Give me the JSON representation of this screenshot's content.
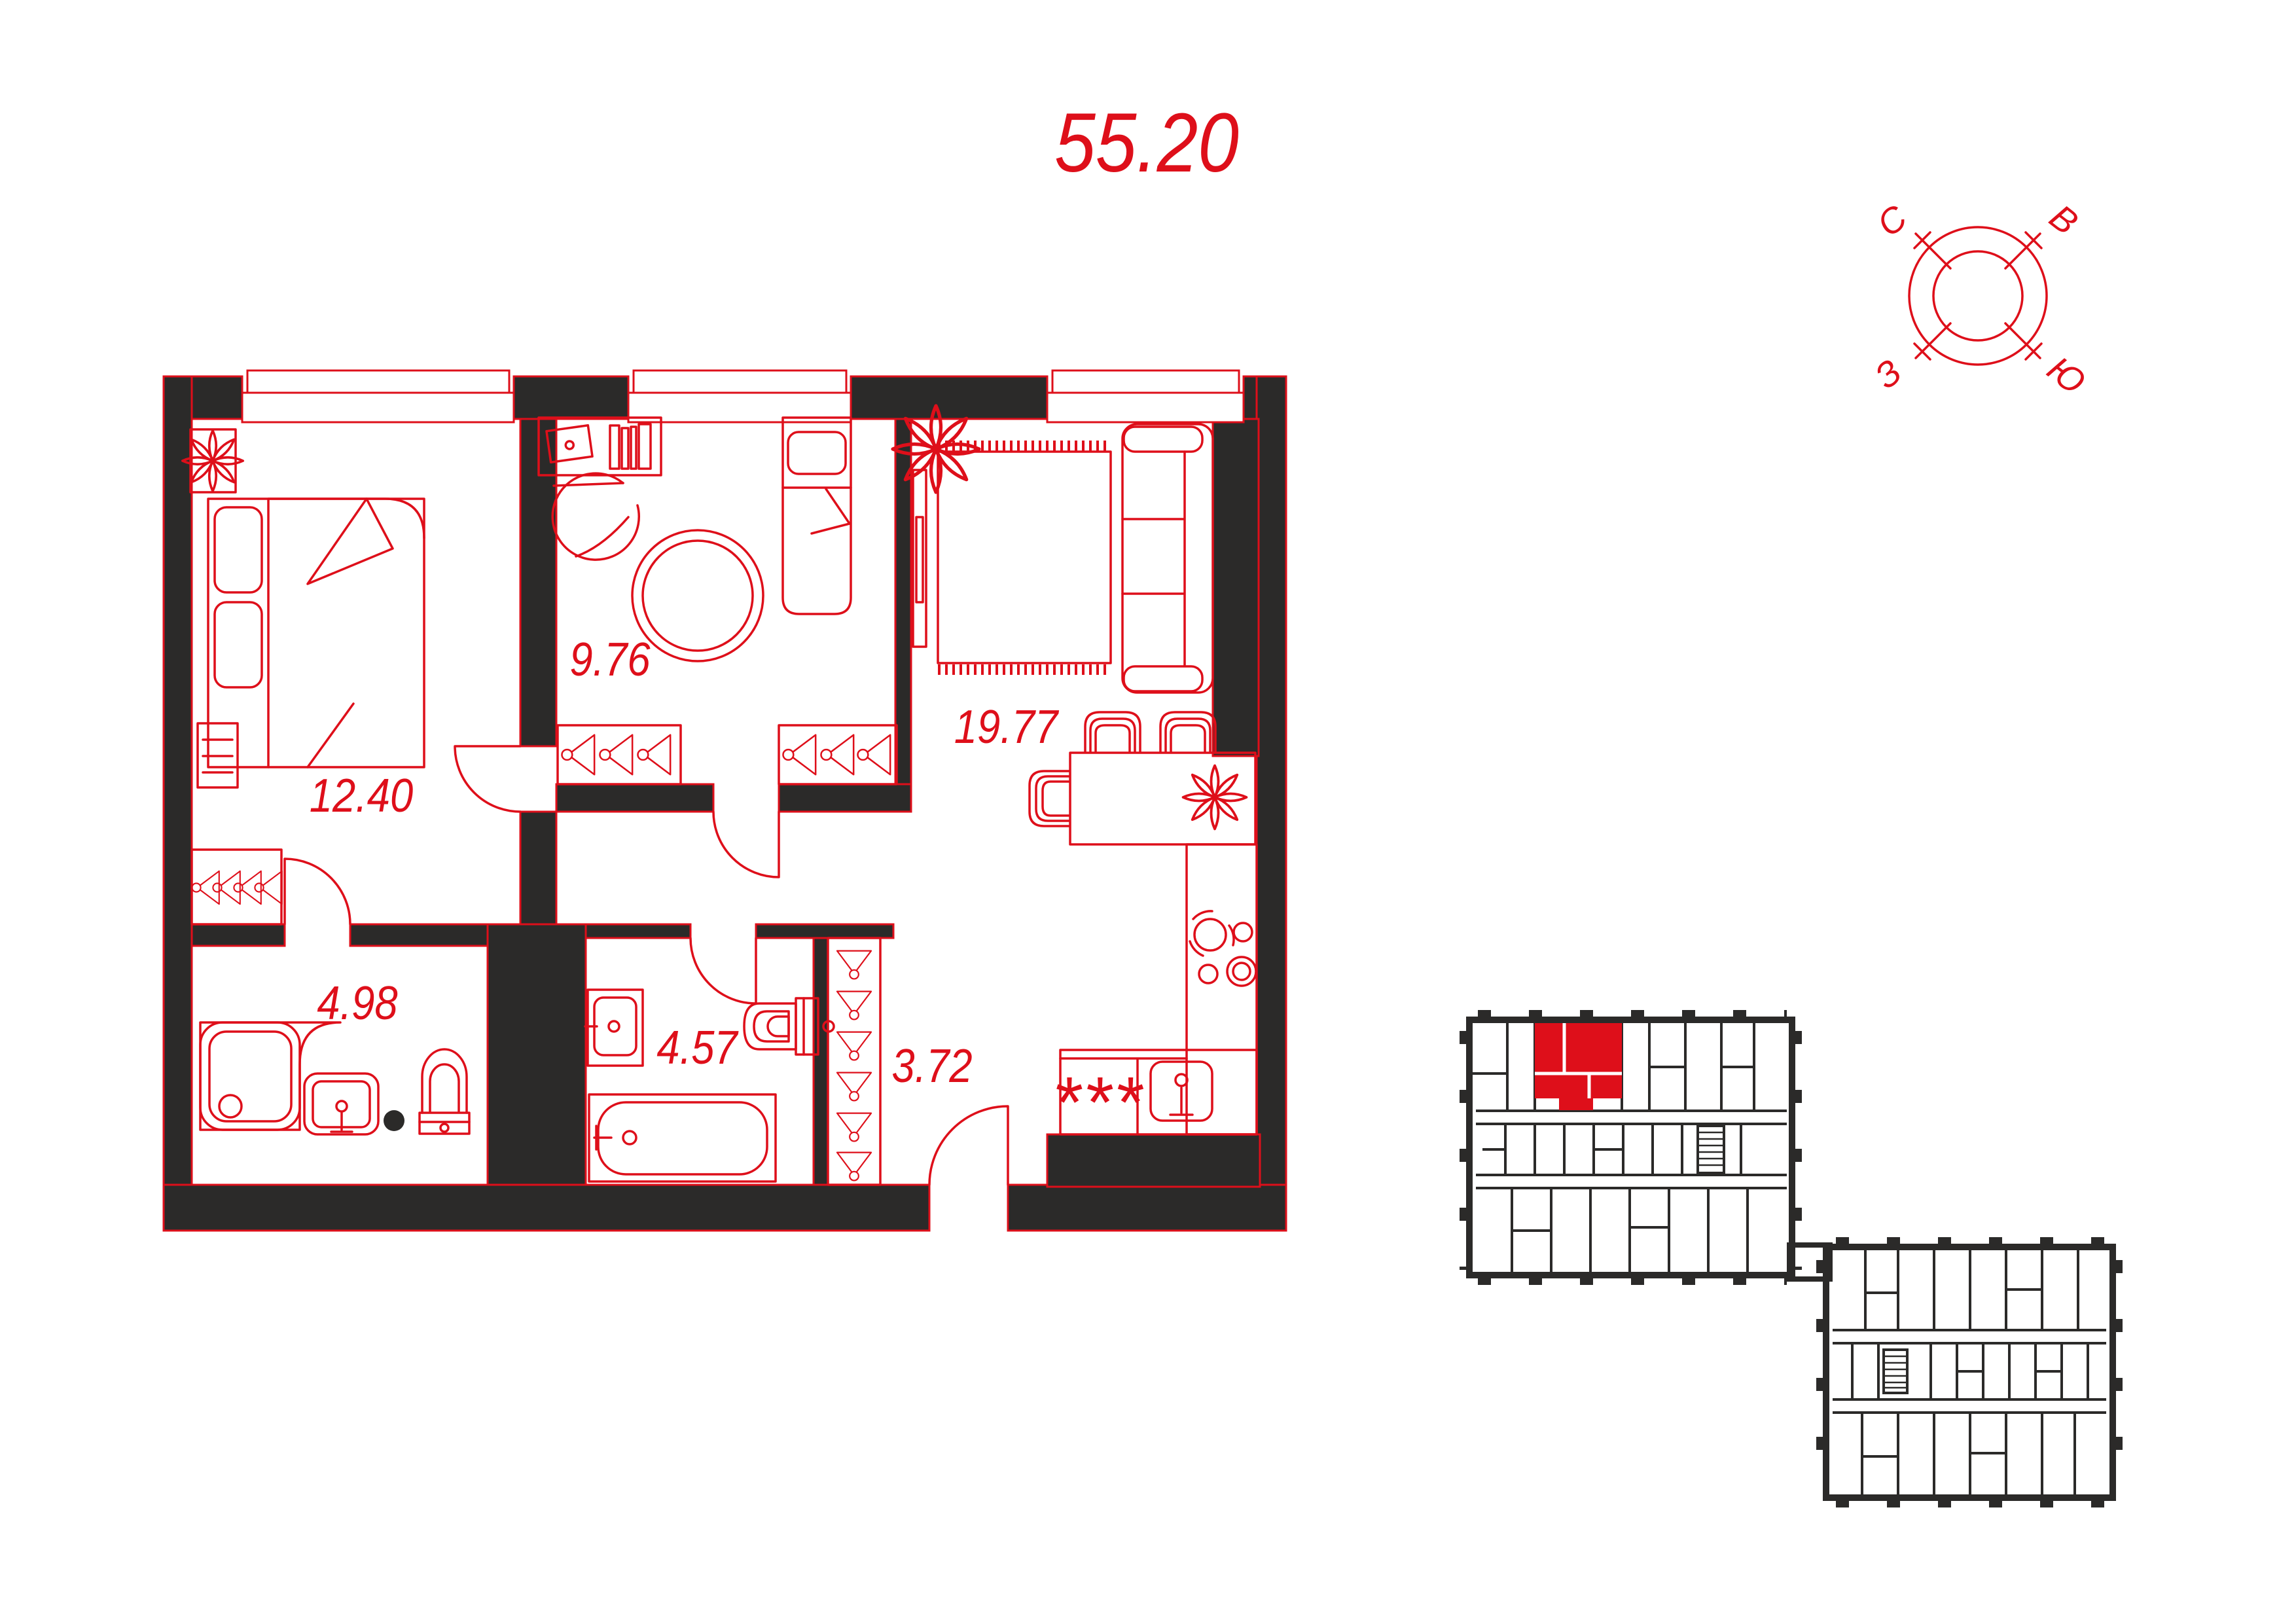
{
  "colors": {
    "accent_red": "#DE0F1A",
    "wall_dark": "#2B2A29",
    "background": "#FFFFFF",
    "unit_highlight": "#DE0F1A"
  },
  "header": {
    "total_area": "55.20"
  },
  "compass": {
    "north": "С",
    "east": "В",
    "west": "З",
    "south": "Ю"
  },
  "floor_plan": {
    "washer_mark": "***",
    "rooms": [
      {
        "name": "bedroom",
        "area": "12.40"
      },
      {
        "name": "room",
        "area": "9.76"
      },
      {
        "name": "kitchen-living",
        "area": "19.77"
      },
      {
        "name": "bathroom",
        "area": "4.98"
      },
      {
        "name": "bathroom-2",
        "area": "4.57"
      },
      {
        "name": "hallway",
        "area": "3.72"
      }
    ]
  },
  "building_overview": {
    "highlight_color": "#DE0F1A"
  }
}
